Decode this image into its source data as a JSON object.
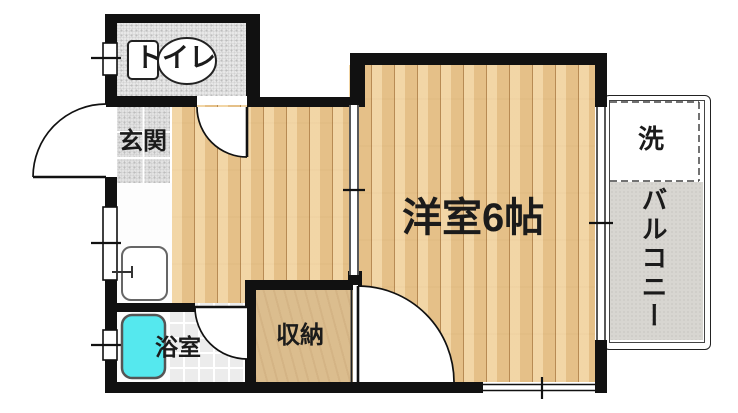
{
  "plan": {
    "title": "1K apartment floor plan",
    "rooms": {
      "toilet": {
        "label": "トイレ"
      },
      "entrance": {
        "label": "玄関"
      },
      "bathroom": {
        "label": "浴室"
      },
      "closet": {
        "label": "収納"
      },
      "main_room": {
        "label": "洋室6帖"
      },
      "washer_area": {
        "label": "洗"
      },
      "balcony": {
        "label": "バルコニー"
      }
    },
    "colors": {
      "wall": "#111111",
      "wood_floor": "#ecca93",
      "closet_floor": "#dbbd8e",
      "balcony_floor": "#d8d6d1",
      "bathtub": "#55e8ee",
      "tile": "#e7e7e7"
    }
  }
}
